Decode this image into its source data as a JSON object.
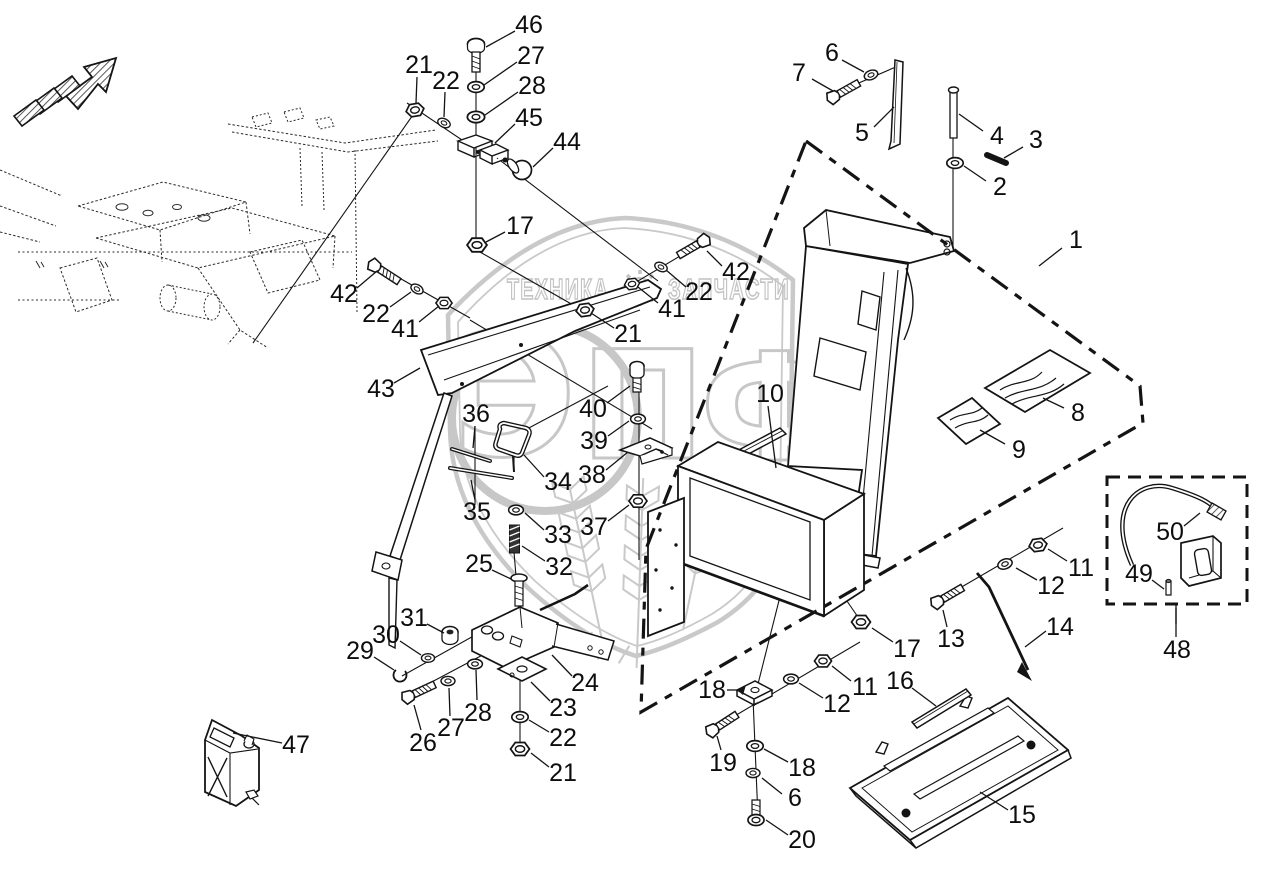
{
  "watermark": {
    "title_left": "ТЕХНИКА",
    "title_right": "ЗАПЧАСТИ",
    "monogram": [
      "Э",
      "П",
      "Ф"
    ]
  },
  "callouts": [
    {
      "n": "46",
      "x": 529,
      "y": 25,
      "x1": 515,
      "y1": 31,
      "x2": 486,
      "y2": 47
    },
    {
      "n": "27",
      "x": 531,
      "y": 56,
      "x1": 517,
      "y1": 62,
      "x2": 484,
      "y2": 85
    },
    {
      "n": "28",
      "x": 532,
      "y": 86,
      "x1": 518,
      "y1": 92,
      "x2": 485,
      "y2": 115
    },
    {
      "n": "45",
      "x": 529,
      "y": 118,
      "x1": 515,
      "y1": 124,
      "x2": 495,
      "y2": 143
    },
    {
      "n": "44",
      "x": 567,
      "y": 142,
      "x1": 553,
      "y1": 148,
      "x2": 533,
      "y2": 167
    },
    {
      "n": "21",
      "x": 419,
      "y": 65,
      "x1": 417,
      "y1": 77,
      "x2": 416,
      "y2": 103
    },
    {
      "n": "22",
      "x": 446,
      "y": 81,
      "x1": 445,
      "y1": 92,
      "x2": 444,
      "y2": 117
    },
    {
      "n": "17",
      "x": 520,
      "y": 226,
      "x1": 505,
      "y1": 232,
      "x2": 486,
      "y2": 242
    },
    {
      "n": "7",
      "x": 799,
      "y": 73,
      "x1": 812,
      "y1": 79,
      "x2": 833,
      "y2": 91
    },
    {
      "n": "6",
      "x": 832,
      "y": 53,
      "x1": 842,
      "y1": 60,
      "x2": 864,
      "y2": 72
    },
    {
      "n": "5",
      "x": 862,
      "y": 133,
      "x1": 874,
      "y1": 127,
      "x2": 894,
      "y2": 107
    },
    {
      "n": "4",
      "x": 997,
      "y": 136,
      "x1": 983,
      "y1": 131,
      "x2": 959,
      "y2": 114
    },
    {
      "n": "3",
      "x": 1036,
      "y": 140,
      "x1": 1023,
      "y1": 147,
      "x2": 1004,
      "y2": 158
    },
    {
      "n": "2",
      "x": 1000,
      "y": 187,
      "x1": 986,
      "y1": 181,
      "x2": 964,
      "y2": 166
    },
    {
      "n": "1",
      "x": 1076,
      "y": 240,
      "x1": 1062,
      "y1": 248,
      "x2": 1039,
      "y2": 266
    },
    {
      "n": "42",
      "x": 344,
      "y": 294,
      "x1": 357,
      "y1": 288,
      "x2": 377,
      "y2": 271
    },
    {
      "n": "22",
      "x": 376,
      "y": 314,
      "x1": 390,
      "y1": 307,
      "x2": 411,
      "y2": 292
    },
    {
      "n": "41",
      "x": 405,
      "y": 329,
      "x1": 419,
      "y1": 322,
      "x2": 439,
      "y2": 306
    },
    {
      "n": "43",
      "x": 381,
      "y": 389,
      "x1": 394,
      "y1": 383,
      "x2": 420,
      "y2": 368
    },
    {
      "n": "42",
      "x": 736,
      "y": 272,
      "x1": 722,
      "y1": 266,
      "x2": 707,
      "y2": 251
    },
    {
      "n": "22",
      "x": 699,
      "y": 292,
      "x1": 686,
      "y1": 287,
      "x2": 666,
      "y2": 270
    },
    {
      "n": "41",
      "x": 672,
      "y": 309,
      "x1": 658,
      "y1": 303,
      "x2": 638,
      "y2": 287
    },
    {
      "n": "21",
      "x": 628,
      "y": 334,
      "x1": 614,
      "y1": 328,
      "x2": 591,
      "y2": 313
    },
    {
      "n": "40",
      "x": 593,
      "y": 409,
      "x1": 607,
      "y1": 403,
      "x2": 630,
      "y2": 386
    },
    {
      "n": "39",
      "x": 594,
      "y": 441,
      "x1": 608,
      "y1": 436,
      "x2": 629,
      "y2": 421
    },
    {
      "n": "38",
      "x": 592,
      "y": 475,
      "x1": 606,
      "y1": 470,
      "x2": 628,
      "y2": 452
    },
    {
      "n": "37",
      "x": 594,
      "y": 527,
      "x1": 608,
      "y1": 521,
      "x2": 629,
      "y2": 505
    },
    {
      "n": "10",
      "x": 770,
      "y": 394,
      "x1": 768,
      "y1": 406,
      "x2": 776,
      "y2": 468
    },
    {
      "n": "36",
      "x": 476,
      "y": 414,
      "x1": 475,
      "y1": 426,
      "x2": 473,
      "y2": 448
    },
    {
      "n": "34",
      "x": 558,
      "y": 482,
      "x1": 544,
      "y1": 477,
      "x2": 524,
      "y2": 455
    },
    {
      "n": "35",
      "x": 477,
      "y": 512,
      "x1": 475,
      "y1": 500,
      "x2": 471,
      "y2": 480
    },
    {
      "n": "33",
      "x": 558,
      "y": 535,
      "x1": 544,
      "y1": 530,
      "x2": 525,
      "y2": 513
    },
    {
      "n": "32",
      "x": 559,
      "y": 567,
      "x1": 545,
      "y1": 561,
      "x2": 522,
      "y2": 546
    },
    {
      "n": "25",
      "x": 479,
      "y": 564,
      "x1": 492,
      "y1": 570,
      "x2": 511,
      "y2": 579
    },
    {
      "n": "31",
      "x": 414,
      "y": 618,
      "x1": 427,
      "y1": 624,
      "x2": 444,
      "y2": 633
    },
    {
      "n": "30",
      "x": 386,
      "y": 635,
      "x1": 400,
      "y1": 641,
      "x2": 421,
      "y2": 655
    },
    {
      "n": "29",
      "x": 360,
      "y": 651,
      "x1": 374,
      "y1": 657,
      "x2": 394,
      "y2": 670
    },
    {
      "n": "26",
      "x": 423,
      "y": 743,
      "x1": 421,
      "y1": 730,
      "x2": 414,
      "y2": 705
    },
    {
      "n": "27",
      "x": 451,
      "y": 728,
      "x1": 450,
      "y1": 716,
      "x2": 449,
      "y2": 688
    },
    {
      "n": "28",
      "x": 478,
      "y": 713,
      "x1": 477,
      "y1": 700,
      "x2": 476,
      "y2": 670
    },
    {
      "n": "24",
      "x": 585,
      "y": 683,
      "x1": 572,
      "y1": 676,
      "x2": 552,
      "y2": 655
    },
    {
      "n": "23",
      "x": 563,
      "y": 708,
      "x1": 550,
      "y1": 701,
      "x2": 531,
      "y2": 682
    },
    {
      "n": "22",
      "x": 563,
      "y": 738,
      "x1": 549,
      "y1": 732,
      "x2": 529,
      "y2": 720
    },
    {
      "n": "21",
      "x": 563,
      "y": 773,
      "x1": 549,
      "y1": 767,
      "x2": 531,
      "y2": 753
    },
    {
      "n": "47",
      "x": 296,
      "y": 745,
      "x1": 282,
      "y1": 743,
      "x2": 233,
      "y2": 733
    },
    {
      "n": "17",
      "x": 907,
      "y": 649,
      "x1": 893,
      "y1": 642,
      "x2": 872,
      "y2": 628
    },
    {
      "n": "13",
      "x": 951,
      "y": 639,
      "x1": 947,
      "y1": 627,
      "x2": 943,
      "y2": 610
    },
    {
      "n": "11",
      "x": 1081,
      "y": 568,
      "x1": 1067,
      "y1": 561,
      "x2": 1048,
      "y2": 549
    },
    {
      "n": "12",
      "x": 1051,
      "y": 586,
      "x1": 1037,
      "y1": 580,
      "x2": 1016,
      "y2": 568
    },
    {
      "n": "14",
      "x": 1060,
      "y": 627,
      "x1": 1046,
      "y1": 631,
      "x2": 1025,
      "y2": 647
    },
    {
      "n": "16",
      "x": 900,
      "y": 681,
      "x1": 912,
      "y1": 688,
      "x2": 936,
      "y2": 706
    },
    {
      "n": "18",
      "x": 712,
      "y": 690,
      "x1": 727,
      "y1": 690,
      "x2": 742,
      "y2": 690
    },
    {
      "n": "11",
      "x": 865,
      "y": 687,
      "x1": 851,
      "y1": 681,
      "x2": 832,
      "y2": 666
    },
    {
      "n": "12",
      "x": 837,
      "y": 704,
      "x1": 823,
      "y1": 698,
      "x2": 799,
      "y2": 683
    },
    {
      "n": "19",
      "x": 723,
      "y": 763,
      "x1": 721,
      "y1": 750,
      "x2": 717,
      "y2": 736
    },
    {
      "n": "18",
      "x": 802,
      "y": 768,
      "x1": 788,
      "y1": 762,
      "x2": 764,
      "y2": 749
    },
    {
      "n": "6",
      "x": 795,
      "y": 798,
      "x1": 782,
      "y1": 794,
      "x2": 762,
      "y2": 778
    },
    {
      "n": "20",
      "x": 802,
      "y": 840,
      "x1": 788,
      "y1": 835,
      "x2": 766,
      "y2": 820
    },
    {
      "n": "15",
      "x": 1022,
      "y": 815,
      "x1": 1008,
      "y1": 810,
      "x2": 980,
      "y2": 792
    },
    {
      "n": "8",
      "x": 1078,
      "y": 413,
      "x1": 1064,
      "y1": 408,
      "x2": 1043,
      "y2": 398
    },
    {
      "n": "9",
      "x": 1019,
      "y": 450,
      "x1": 1005,
      "y1": 444,
      "x2": 980,
      "y2": 430
    },
    {
      "n": "50",
      "x": 1170,
      "y": 532,
      "x1": 1184,
      "y1": 526,
      "x2": 1200,
      "y2": 513
    },
    {
      "n": "49",
      "x": 1139,
      "y": 574,
      "x1": 1152,
      "y1": 580,
      "x2": 1164,
      "y2": 589
    },
    {
      "n": "48",
      "x": 1177,
      "y": 650,
      "x1": 1176,
      "y1": 637,
      "x2": 1176,
      "y2": 608
    }
  ]
}
